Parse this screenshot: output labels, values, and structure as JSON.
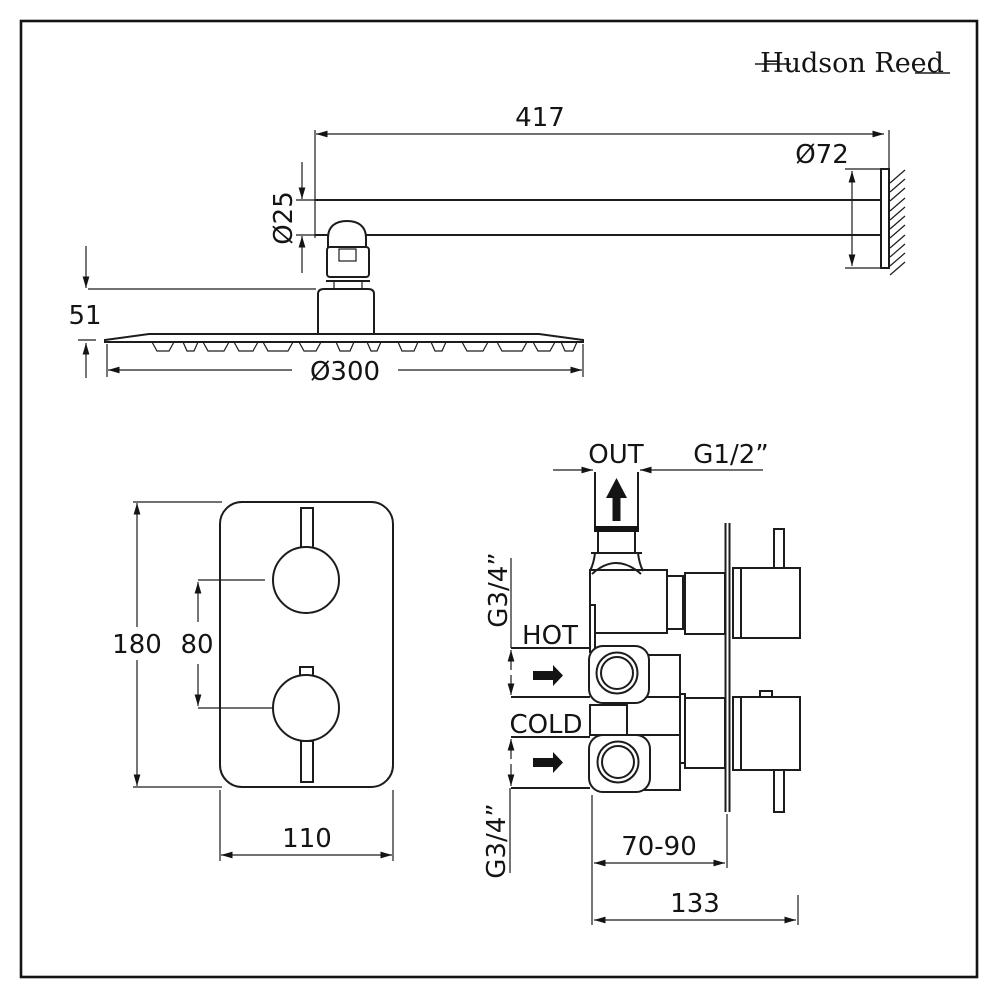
{
  "brand": {
    "name": "Hudson Reed"
  },
  "colors": {
    "ink": "#1c1c1c",
    "background": "#ffffff"
  },
  "shower_arm_view": {
    "arm_length": "417",
    "flange_diameter": "Ø72",
    "arm_diameter": "Ø25",
    "connector_height": "51",
    "head_diameter": "Ø300"
  },
  "valve_front_view": {
    "plate_height": "180",
    "handle_spacing": "80",
    "plate_width": "110"
  },
  "valve_side_view": {
    "outlet_label": "OUT",
    "outlet_thread": "G1/2”",
    "hot_thread": "G3/4”",
    "hot_label": "HOT",
    "cold_label": "COLD",
    "cold_thread": "G3/4”",
    "depth_range": "70-90",
    "total_depth": "133"
  }
}
